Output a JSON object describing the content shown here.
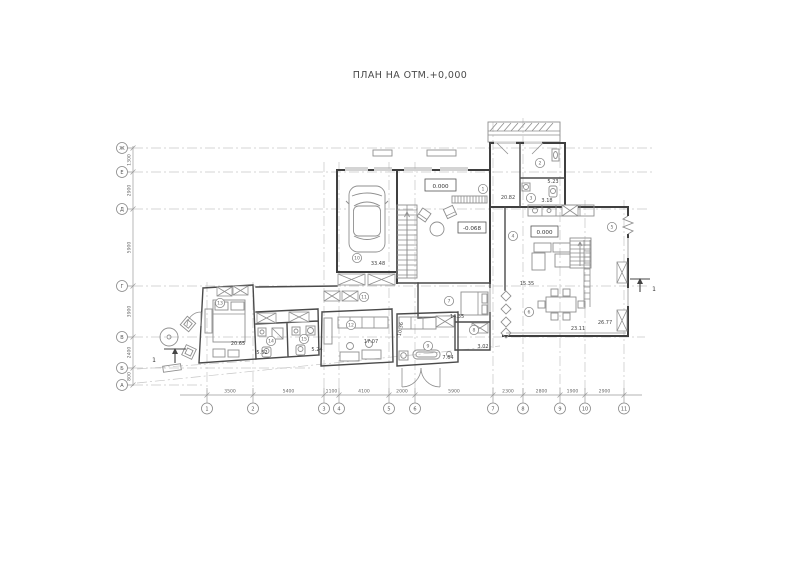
{
  "title": "ПЛАН НА ОТМ.+0,000",
  "grid": {
    "rows": [
      "Ж",
      "Е",
      "Д",
      "Г",
      "В",
      "Б",
      "А"
    ],
    "cols": [
      "1",
      "2",
      "3",
      "4",
      "5",
      "6",
      "7",
      "8",
      "9",
      "10",
      "11"
    ],
    "row_dims": [
      "1300",
      "2900",
      "5900",
      "3900",
      "2400",
      "800"
    ],
    "col_dims": [
      "3500",
      "5400",
      "1100",
      "4100",
      "2000",
      "5900",
      "2300",
      "2800",
      "1900",
      "2900"
    ]
  },
  "elevations": [
    "0.000",
    "-0.068",
    "0.000"
  ],
  "rooms": [
    {
      "num": "1",
      "area": "20.82"
    },
    {
      "num": "2",
      "area": "5.23"
    },
    {
      "num": "3",
      "area": "3.18"
    },
    {
      "num": "4"
    },
    {
      "num": "5",
      "area": "26.77"
    },
    {
      "num": "6",
      "area": "23.11"
    },
    {
      "num": "7",
      "area": "14.35"
    },
    {
      "num": "8",
      "area": "3.02"
    },
    {
      "num": "9",
      "area": "7.64"
    },
    {
      "num": "10",
      "area": "33.48"
    },
    {
      "num": "11",
      "area": "10.36"
    },
    {
      "num": "12",
      "area": "17.07"
    },
    {
      "num": "13",
      "area": "20.65"
    },
    {
      "num": "14",
      "area": "5.52"
    },
    {
      "num": "15",
      "area": "5.24"
    }
  ],
  "extra_labels": {
    "lounge_area": "15.35"
  },
  "section_label": "1"
}
